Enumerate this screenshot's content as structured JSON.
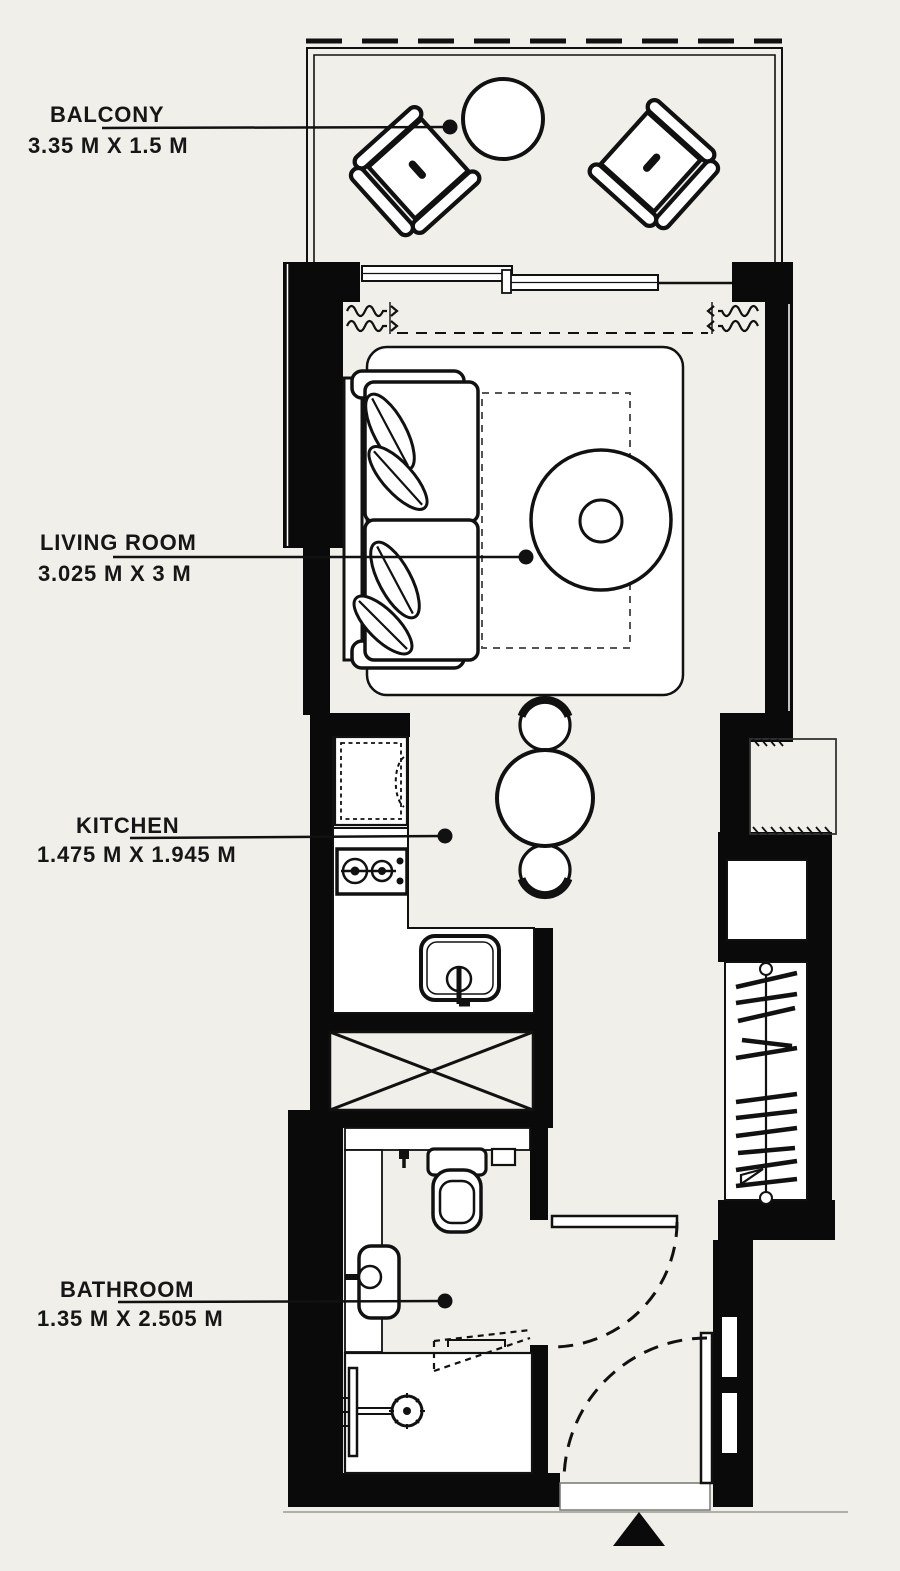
{
  "page": {
    "type": "apartment-floor-plan",
    "background_color": "#f0efe9",
    "wall_color": "#0a0a0a",
    "line_color": "#111111",
    "fixture_fill": "#ffffff"
  },
  "rooms": [
    {
      "id": "balcony",
      "name": "BALCONY",
      "dimensions": "3.35 M X 1.5 M"
    },
    {
      "id": "living-room",
      "name": "LIVING ROOM",
      "dimensions": "3.025 M X 3 M"
    },
    {
      "id": "kitchen",
      "name": "KITCHEN",
      "dimensions": "1.475 M X 1.945 M"
    },
    {
      "id": "bathroom",
      "name": "BATHROOM",
      "dimensions": "1.35 M X 2.505 M"
    }
  ],
  "furniture_icons": [
    "balcony-armchair-icon",
    "balcony-table-icon",
    "sofa-icon",
    "leaf-cushion-icon",
    "rug-icon",
    "coffee-table-icon",
    "curtain-icon",
    "sliding-door-icon",
    "fridge-icon",
    "stove-icon",
    "kitchen-sink-icon",
    "dining-table-icon",
    "dining-chair-icon",
    "shaft-cross-icon",
    "wardrobe-hangers-icon",
    "toilet-icon",
    "vanity-basin-icon",
    "shower-icon",
    "door-swing-icon",
    "entrance-arrow-icon"
  ]
}
